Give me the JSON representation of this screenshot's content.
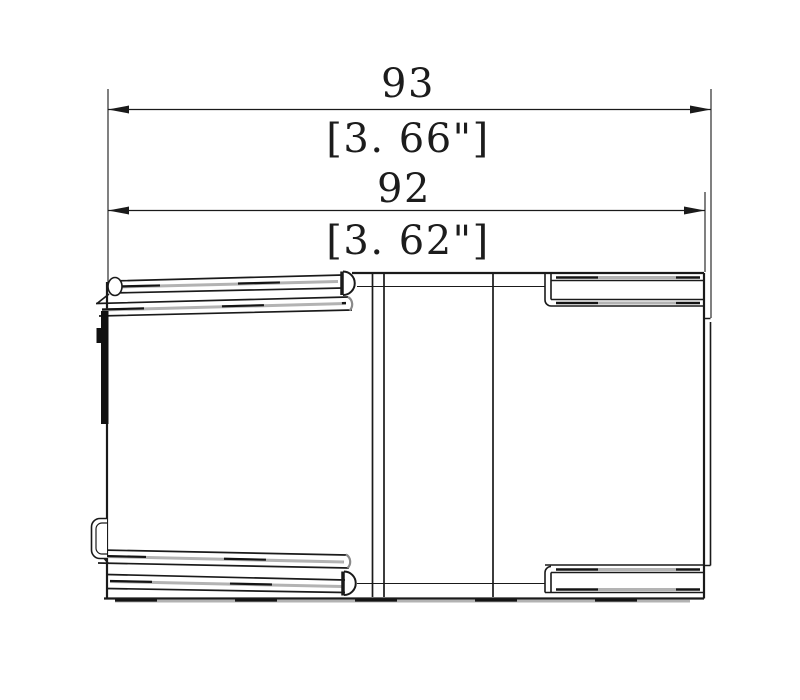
{
  "drawing": {
    "type": "engineering-dimension-drawing",
    "view": "part-top-view",
    "dimensions": {
      "overall": {
        "mm": "93",
        "inch": "[3. 66\"]"
      },
      "inner": {
        "mm": "92",
        "inch": "[3. 62\"]"
      }
    },
    "colors": {
      "line": "#1a1a1a",
      "gray_highlight": "#b3b3b3",
      "gray_cap": "#8a8a8a",
      "background": "#ffffff"
    }
  }
}
